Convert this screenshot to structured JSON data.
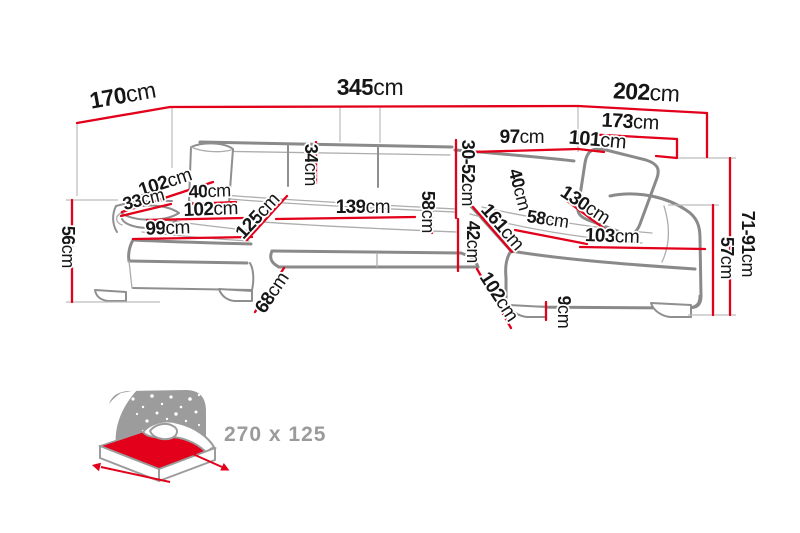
{
  "diagram_title": "U-shaped corner sofa dimension diagram",
  "colors": {
    "dimension_line": "#e2001a",
    "sofa_outline": "#8a8a8a",
    "label_text": "#161616",
    "icon_gray": "#9c9c9c"
  },
  "dims": {
    "back_left": {
      "v": "170",
      "u": "cm"
    },
    "total_width": {
      "v": "345",
      "u": "cm"
    },
    "back_right": {
      "v": "202",
      "u": "cm"
    },
    "right_depth_total": {
      "v": "173",
      "u": "cm"
    },
    "right_inner": {
      "v": "101",
      "u": "cm"
    },
    "right_back_seg": {
      "v": "97",
      "u": "cm"
    },
    "backrest_height": {
      "v": "30-52",
      "u": "cm"
    },
    "back_cushion": {
      "v": "34",
      "u": "cm"
    },
    "left_arm_diag": {
      "v": "102",
      "u": "cm"
    },
    "left_arm_pillow": {
      "v": "33",
      "u": "cm"
    },
    "left_pillow": {
      "v": "40",
      "u": "cm"
    },
    "left_seat_width": {
      "v": "102",
      "u": "cm"
    },
    "left_chaise_front": {
      "v": "99",
      "u": "cm"
    },
    "left_chaise_depth": {
      "v": "125",
      "u": "cm"
    },
    "center_seat_width": {
      "v": "139",
      "u": "cm"
    },
    "center_seat_depth": {
      "v": "58",
      "u": "cm"
    },
    "seat_height": {
      "v": "42",
      "u": "cm"
    },
    "right_chaise_diag": {
      "v": "161",
      "u": "cm"
    },
    "right_pillow": {
      "v": "40",
      "u": "cm"
    },
    "right_seat_depth": {
      "v": "58",
      "u": "cm"
    },
    "right_cushion_diag": {
      "v": "130",
      "u": "cm"
    },
    "right_chaise_front": {
      "v": "103",
      "u": "cm"
    },
    "total_height": {
      "v": "71-91",
      "u": "cm"
    },
    "seat_back_height": {
      "v": "57",
      "u": "cm"
    },
    "left_height": {
      "v": "56",
      "u": "cm"
    },
    "left_chaise_side": {
      "v": "68",
      "u": "cm"
    },
    "right_chaise_side": {
      "v": "102",
      "u": "cm"
    },
    "leg_height": {
      "v": "9",
      "u": "cm"
    },
    "sleeping_area": {
      "v": "270 x 125",
      "u": ""
    }
  }
}
